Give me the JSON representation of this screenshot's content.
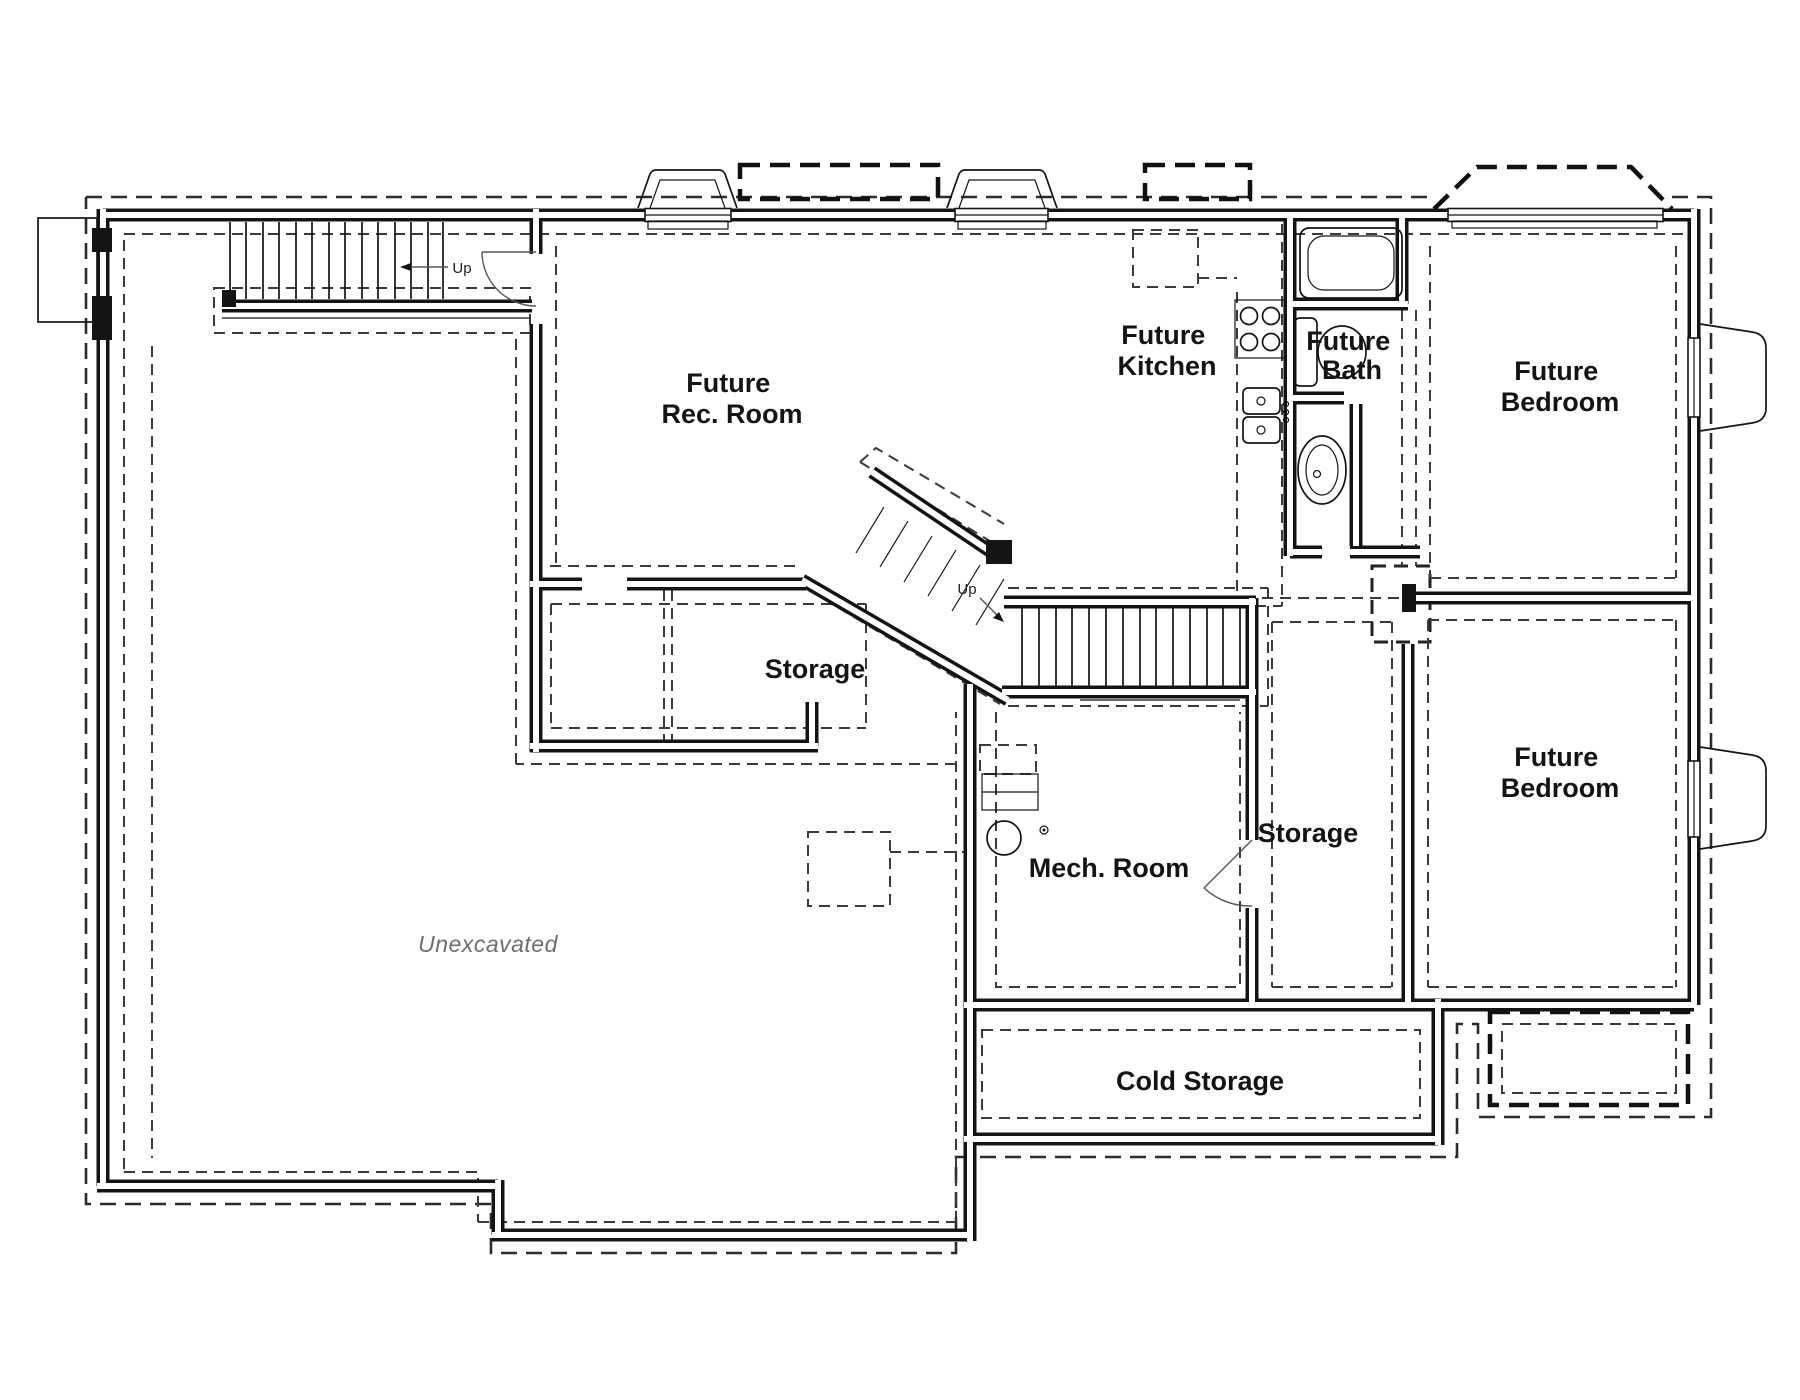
{
  "colors": {
    "line": "#141414",
    "muted": "#6e6e6e",
    "background": "#ffffff"
  },
  "labels": {
    "rec_room": {
      "line1": "Future",
      "line2": "Rec. Room"
    },
    "kitchen": {
      "line1": "Future",
      "line2": "Kitchen"
    },
    "bath": {
      "line1": "Future",
      "line2": "Bath"
    },
    "bedroom_top": {
      "line1": "Future",
      "line2": "Bedroom"
    },
    "bedroom_bottom": {
      "line1": "Future",
      "line2": "Bedroom"
    },
    "storage_left": "Storage",
    "storage_right": "Storage",
    "mech_room": "Mech. Room",
    "cold_storage": "Cold Storage",
    "unexcavated": "Unexcavated",
    "stairs_up_main": "Up",
    "stairs_up_entry": "Up"
  }
}
